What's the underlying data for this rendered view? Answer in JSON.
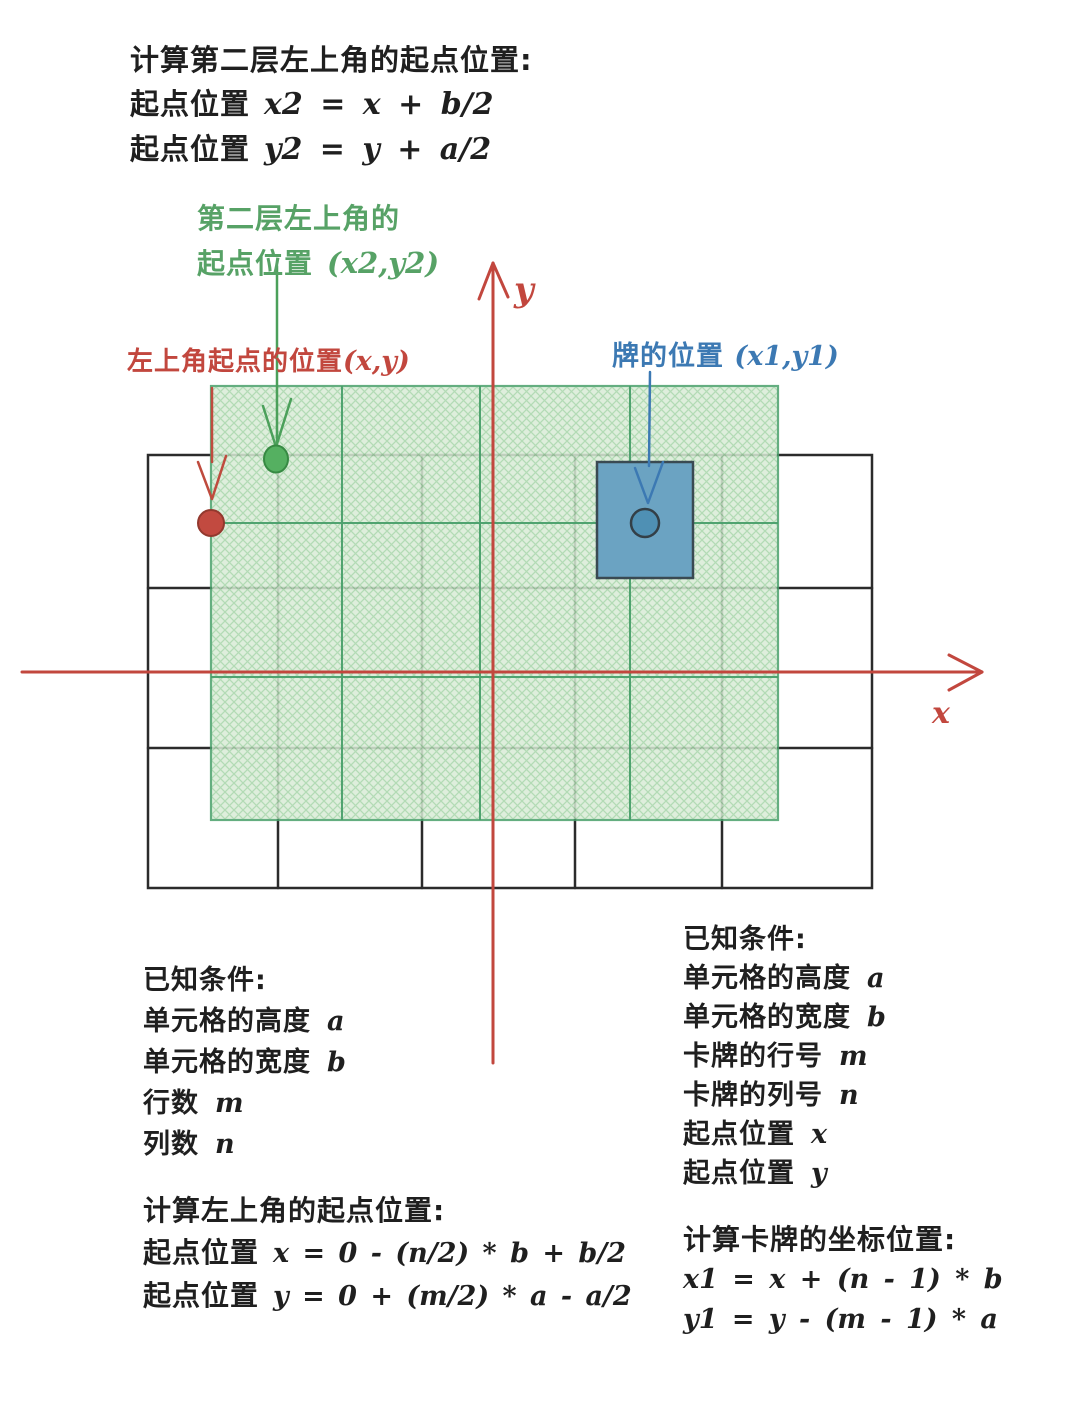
{
  "colors": {
    "ink": "#1f1f1f",
    "red_accent": "#c2473e",
    "green_text": "#57a266",
    "green_line": "#49a06b",
    "green_hatch_fill": "#d9ecd7",
    "blue_accent": "#3c79b3",
    "card_fill": "#6ba3c2"
  },
  "top_block": {
    "title": "计算第二层左上角的起点位置:",
    "lines": [
      {
        "label": "起点位置",
        "formula": "x2 = x + b/2"
      },
      {
        "label": "起点位置",
        "formula": "y2 = y + a/2"
      }
    ]
  },
  "green_label": {
    "line1": "第二层左上角的",
    "line2_label": "起点位置",
    "line2_formula": "(x2,y2)"
  },
  "red_label": {
    "label": "左上角起点的位置",
    "formula": "(x,y)"
  },
  "blue_label": {
    "label": "牌的位置",
    "formula": "(x1,y1)"
  },
  "axes": {
    "x": "x",
    "y": "y"
  },
  "left_known": {
    "title": "已知条件:",
    "items": [
      {
        "label": "单元格的高度",
        "var": "a"
      },
      {
        "label": "单元格的宽度",
        "var": "b"
      },
      {
        "label": "行数",
        "var": "m"
      },
      {
        "label": "列数",
        "var": "n"
      }
    ]
  },
  "left_calc": {
    "title": "计算左上角的起点位置:",
    "lines": [
      {
        "label": "起点位置",
        "formula": "x = 0 - (n/2) * b + b/2"
      },
      {
        "label": "起点位置",
        "formula": "y = 0 + (m/2) * a - a/2"
      }
    ]
  },
  "right_known": {
    "title": "已知条件:",
    "items": [
      {
        "label": "单元格的高度",
        "var": "a"
      },
      {
        "label": "单元格的宽度",
        "var": "b"
      },
      {
        "label": "卡牌的行号",
        "var": "m"
      },
      {
        "label": "卡牌的列号",
        "var": "n"
      },
      {
        "label": "起点位置",
        "var": "x"
      },
      {
        "label": "起点位置",
        "var": "y"
      }
    ]
  },
  "right_calc": {
    "title": "计算卡牌的坐标位置:",
    "lines": [
      "x1 = x + (n - 1) * b",
      "y1 = y - (m - 1) * a"
    ]
  }
}
